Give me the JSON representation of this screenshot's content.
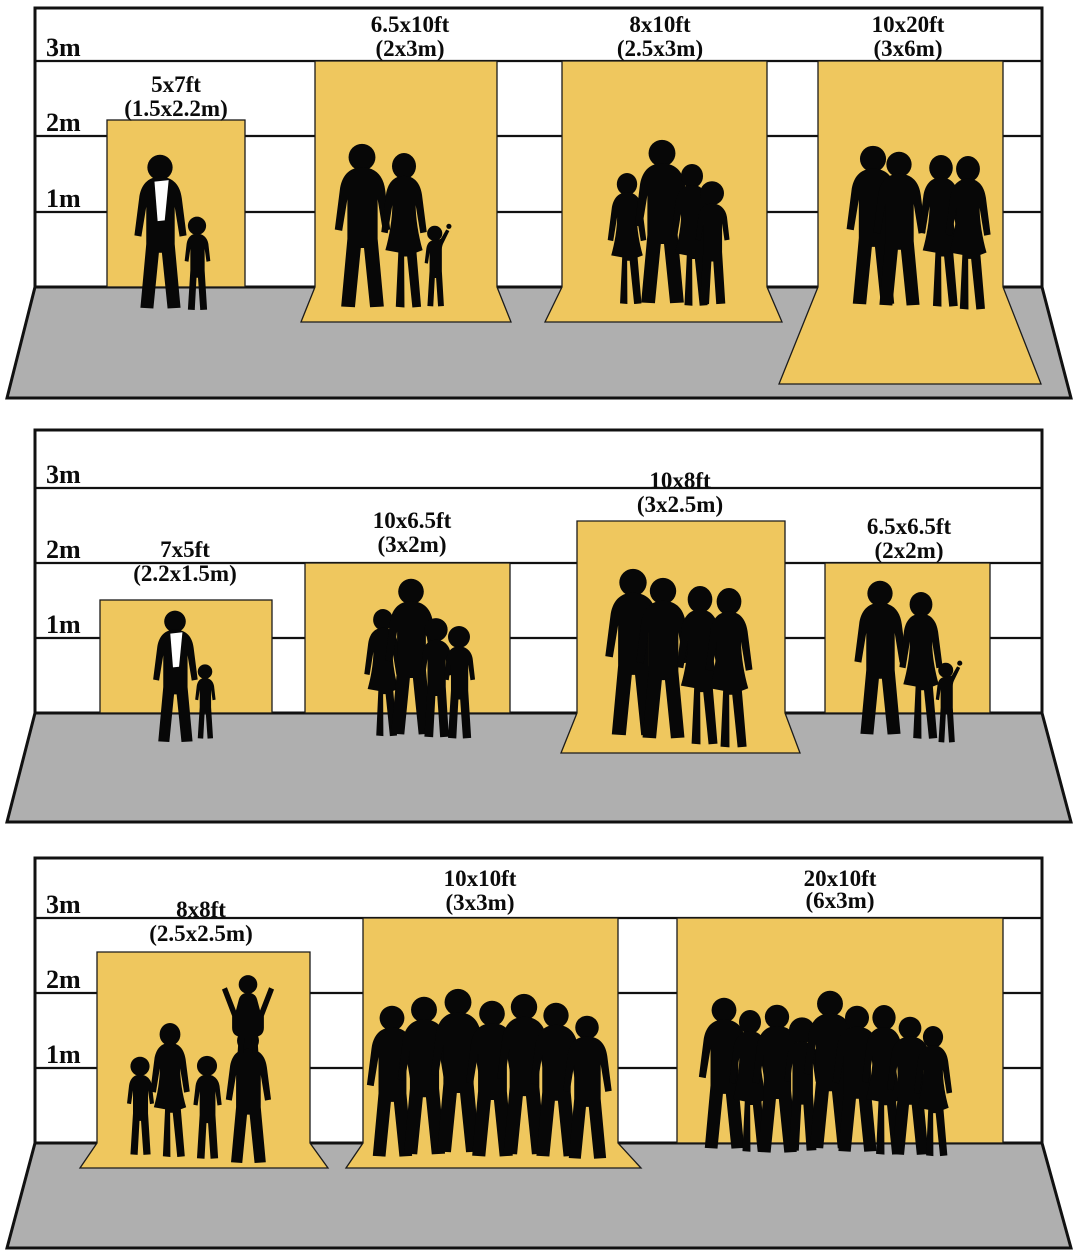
{
  "diagram": {
    "description": "Photography backdrop size comparison chart with human silhouettes for scale",
    "colors": {
      "backdrop_yellow": "#EFC75E",
      "floor_gray": "#AFAFAF",
      "wall_white": "#FFFFFF",
      "outline_black": "#111111",
      "silhouette_black": "#070707"
    },
    "panels": [
      {
        "meter_labels": [
          "3m",
          "2m",
          "1m"
        ],
        "backdrops": [
          {
            "size_ft": "5x7ft",
            "size_m": "(1.5x2.2m)",
            "floor_sweep": false,
            "people": "1 adult with 1 child"
          },
          {
            "size_ft": "6.5x10ft",
            "size_m": "(2x3m)",
            "floor_sweep": true,
            "people": "2 adults with 1 child"
          },
          {
            "size_ft": "8x10ft",
            "size_m": "(2.5x3m)",
            "floor_sweep": true,
            "people": "family of 4"
          },
          {
            "size_ft": "10x20ft",
            "size_m": "(3x6m)",
            "floor_sweep": true,
            "people": "4 adults"
          }
        ]
      },
      {
        "meter_labels": [
          "3m",
          "2m",
          "1m"
        ],
        "backdrops": [
          {
            "size_ft": "7x5ft",
            "size_m": "(2.2x1.5m)",
            "floor_sweep": false,
            "people": "1 adult with 1 child"
          },
          {
            "size_ft": "10x6.5ft",
            "size_m": "(3x2m)",
            "floor_sweep": false,
            "people": "family of 4"
          },
          {
            "size_ft": "10x8ft",
            "size_m": "(3x2.5m)",
            "floor_sweep": true,
            "people": "4 adults"
          },
          {
            "size_ft": "6.5x6.5ft",
            "size_m": "(2x2m)",
            "floor_sweep": false,
            "people": "2 adults with 1 child"
          }
        ]
      },
      {
        "meter_labels": [
          "3m",
          "2m",
          "1m"
        ],
        "backdrops": [
          {
            "size_ft": "8x8ft",
            "size_m": "(2.5x2.5m)",
            "floor_sweep": true,
            "people": "family of 5 with child on shoulders"
          },
          {
            "size_ft": "10x10ft",
            "size_m": "(3x3m)",
            "floor_sweep": true,
            "people": "group of 7"
          },
          {
            "size_ft": "20x10ft",
            "size_m": "(6x3m)",
            "floor_sweep": false,
            "people": "group of 9"
          }
        ]
      }
    ]
  }
}
